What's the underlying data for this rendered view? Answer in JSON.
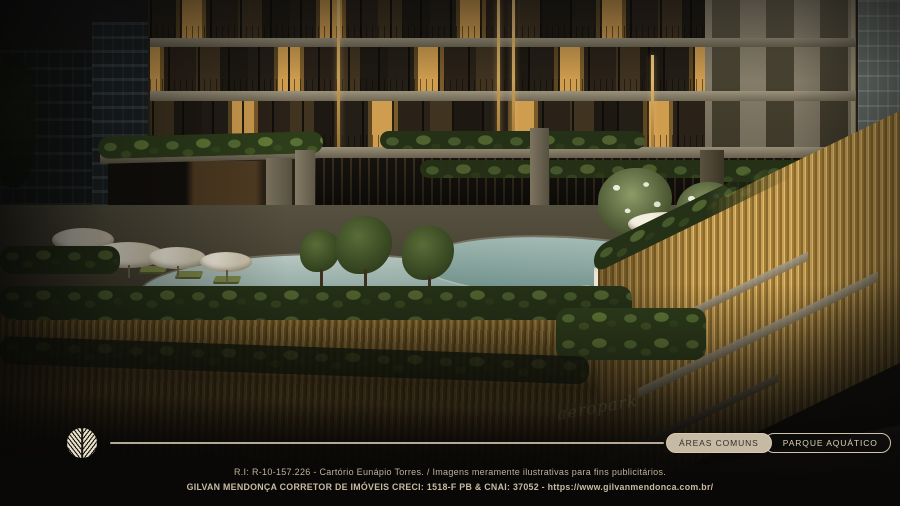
{
  "scene": {
    "signage_text": "aeropark"
  },
  "nav": {
    "buttons": [
      {
        "label": "ÁREAS COMUNS",
        "active": true
      },
      {
        "label": "PARQUE AQUÁTICO",
        "active": false
      }
    ]
  },
  "footer": {
    "line1": "R.I: R-10-157.226 - Cartório Eunápio Torres. / Imagens meramente ilustrativas para fins publicitários.",
    "line2": "GILVAN MENDONÇA CORRETOR DE IMÓVEIS CRECI: 1518-F PB & CNAI: 37052 - https://www.gilvanmendonca.com.br/"
  },
  "logo": {
    "icon": "leaf-emblem-icon"
  },
  "colors": {
    "accent_cream": "#d3c6b0",
    "pill_fill": "#c6baa4",
    "pill_text_dark": "#332e26",
    "pill_text_light": "#d9cfba",
    "fence_gold": "#b8914c",
    "pool_water": "#9db7b2",
    "warm_window": "#cf9d4f",
    "footer_text": "#bfb19b",
    "background_dark": "#0b0a08"
  }
}
